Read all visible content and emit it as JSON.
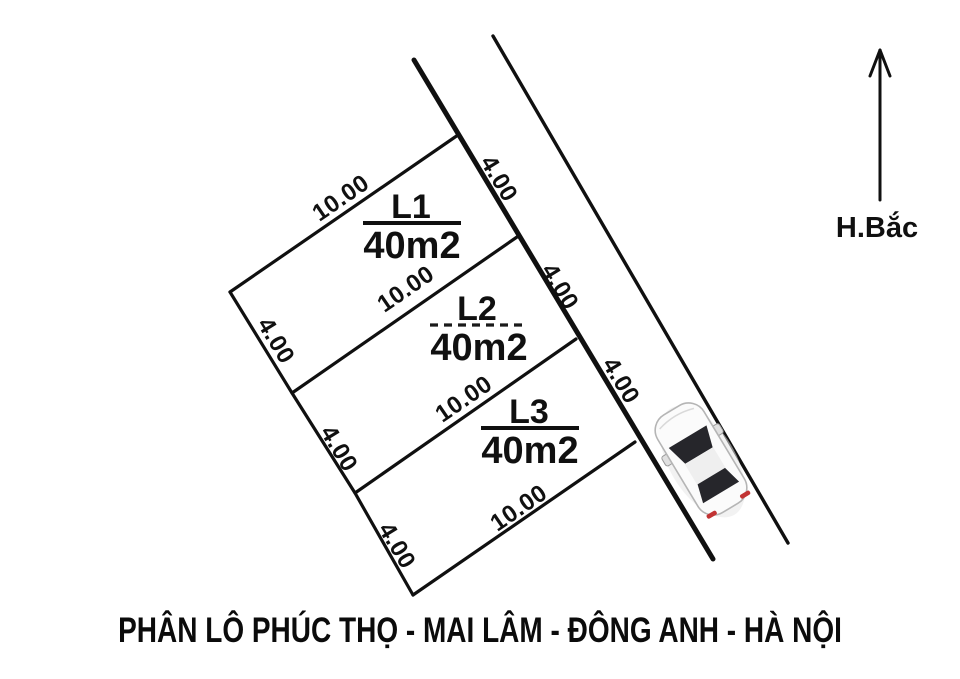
{
  "title": "PHÂN LÔ PHÚC THỌ - MAI LÂM - ĐÔNG ANH - HÀ NỘI",
  "compass": {
    "label": "H.Bắc"
  },
  "plots": [
    {
      "id": "L1",
      "area": "40m2",
      "width_label": "10.00",
      "depth_label": "4.00"
    },
    {
      "id": "L2",
      "area": "40m2",
      "width_label": "10.00",
      "depth_label": "4.00"
    },
    {
      "id": "L3",
      "area": "40m2",
      "width_label": "10.00",
      "depth_label": "4.00",
      "bottom_width_label": "10.00"
    }
  ],
  "colors": {
    "label_red": "#e2232a",
    "line_black": "#101010"
  }
}
